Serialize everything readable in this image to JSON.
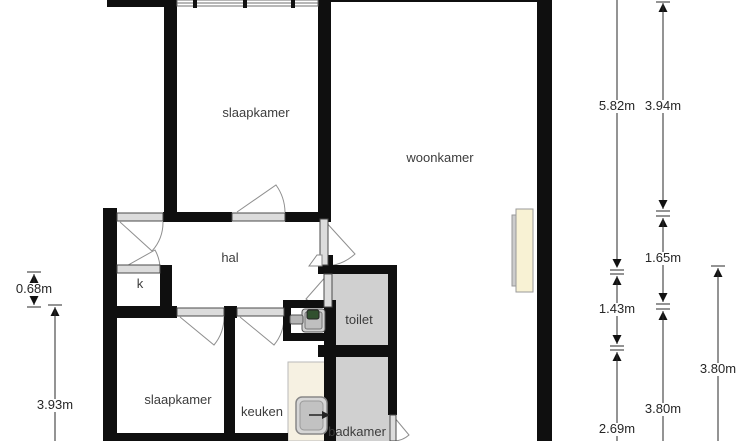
{
  "rooms": {
    "slaapkamer_top": "slaapkamer",
    "woonkamer": "woonkamer",
    "hal": "hal",
    "kast": "k",
    "toilet": "toilet",
    "slaapkamer_bottom": "slaapkamer",
    "keuken": "keuken",
    "badkamer": "badkamer"
  },
  "dimensions": {
    "d582": "5.82m",
    "d394": "3.94m",
    "d165": "1.65m",
    "d143": "1.43m",
    "d380_mid": "3.80m",
    "d380_right": "3.80m",
    "d269": "2.69m",
    "d068": "0.68m",
    "d393": "3.93m"
  },
  "colors": {
    "wall": "#0f0f0f",
    "wet_room_floor": "#d0d0d0",
    "kitchen_counter": "#f6f1e2",
    "radiator": "#f8f2d4",
    "door_leaf": "#dcdcdc",
    "swing_arc": "#8f8f8f",
    "dimension_line": "#2a2a2a",
    "label_text": "#3c3c3c"
  }
}
